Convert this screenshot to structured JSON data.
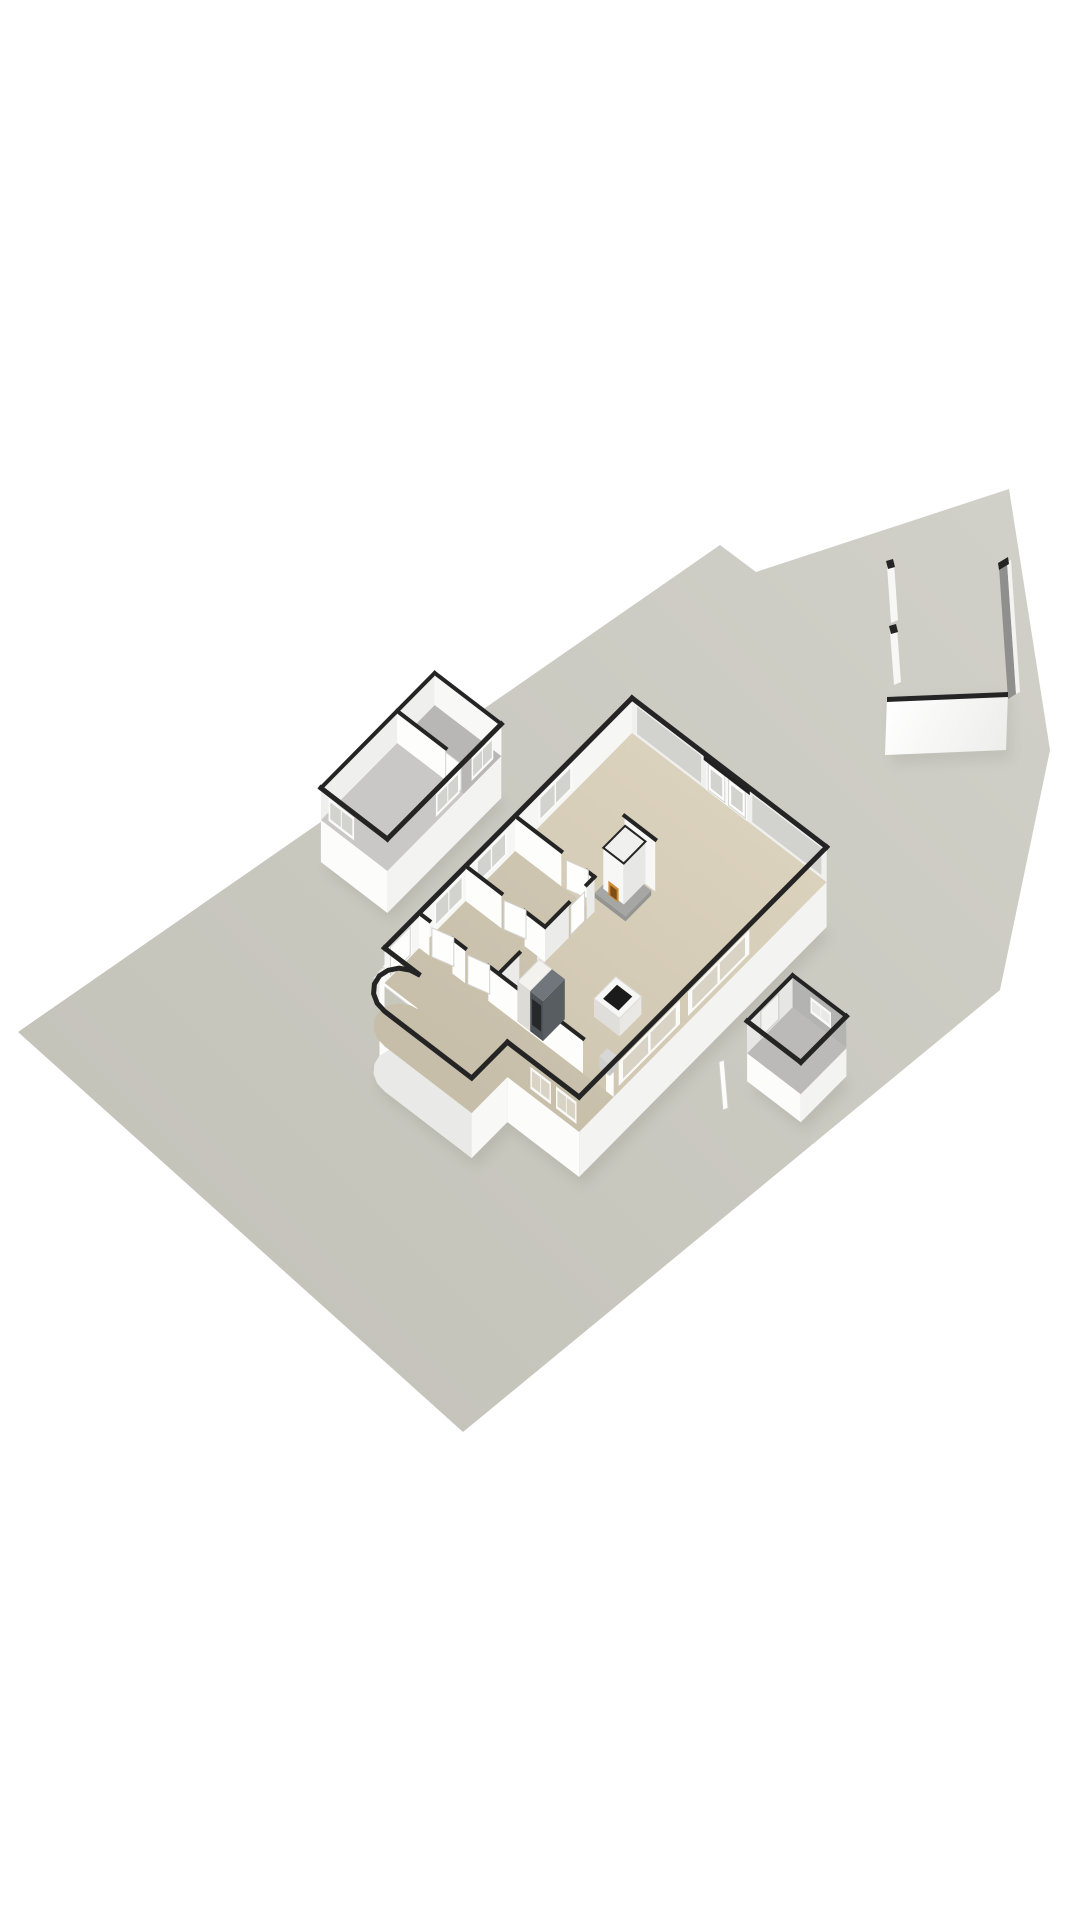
{
  "scene": {
    "type": "3d-floorplan-render",
    "description": "Isometric 3D render of a ground floor plan: main house with curved stair bay on an irregular plot, detached two-room garage, freestanding garden walls, garden shed and a small fence segment",
    "background_color": "#ffffff"
  },
  "structures": {
    "plot": {
      "name": "building plot",
      "shape": "irregular seven-point polygon"
    },
    "main_house": {
      "name": "main house ground floor",
      "features": [
        "glazed facade with double garden doors",
        "freestanding fireplace with burning fire",
        "kitchen tall units",
        "kitchen island with black cooktop",
        "hallway rooms with doors",
        "corridor with rounded stair bay",
        "front door",
        "outside entrance steps",
        "window bands"
      ]
    },
    "garage": {
      "name": "detached garage outbuilding",
      "rooms": 2,
      "features": [
        "partition wall",
        "window openings"
      ]
    },
    "garden_walls": {
      "name": "freestanding garden walls",
      "segments": 4
    },
    "shed": {
      "name": "garden shed",
      "features": [
        "window opening",
        "door"
      ]
    },
    "fence": {
      "name": "low fence post segment"
    }
  },
  "colors": {
    "background": "#ffffff",
    "plot_light": "#d1d0c8",
    "plot_dark": "#c5c4bb",
    "wall_top": "#242424",
    "transom": "#202020",
    "ext_face_sw": "#fcfcfa",
    "ext_face_se": "#f3f3f1",
    "bay_face": "#f8f8f6",
    "bay_shade": "#e9e9e7",
    "int_face_bright": "#fdfdfb",
    "int_face_shaded": "#ebebe9",
    "nw_face": "#f6f6f4",
    "floor_main_1": "#dbd2bd",
    "floor_main_2": "#cdc4af",
    "floor_tint": "rgba(90,85,70,0.06)",
    "floor_garage": "#c9c8c6",
    "floor_garage_small": "#b8b7b5",
    "floor_shed": "#bbbab8",
    "shed_far_ne": "#b3b3b1",
    "shed_far_nw": "#e6e6e4",
    "glass_out": "#d2d2cf",
    "glass_in": "#d9d3c6",
    "frame": "#fafaf8",
    "mullion": "#f0f0ee",
    "door_leaf": "#fefefc",
    "door_edge": "#d2d2d0",
    "fire_amber": "#d08a32",
    "fire_inner": "#7e4e1a",
    "hearth_top": "#a6a6a4",
    "hearth_side": "#949492",
    "fireplace_body": "#f7f7f5",
    "fireplace_side": "#e7e7e5",
    "fridge_top": "#f4f2ee",
    "fridge_se": "#e9e7e1",
    "fridge_sw": "#dddbd5",
    "oven_top": "#70767b",
    "oven_se": "#585d61",
    "oven_sw": "#4e5357",
    "cooktop": "#1b1b1b",
    "sink": "#d7d7d5",
    "step_a": "#ffffff",
    "step_b": "#efefed",
    "step_edge": "#d9d9d7",
    "garden_wall_inner": "#8f8f8d",
    "garden_wall_face": "#f7f7f5",
    "shadow": "#57554a"
  }
}
